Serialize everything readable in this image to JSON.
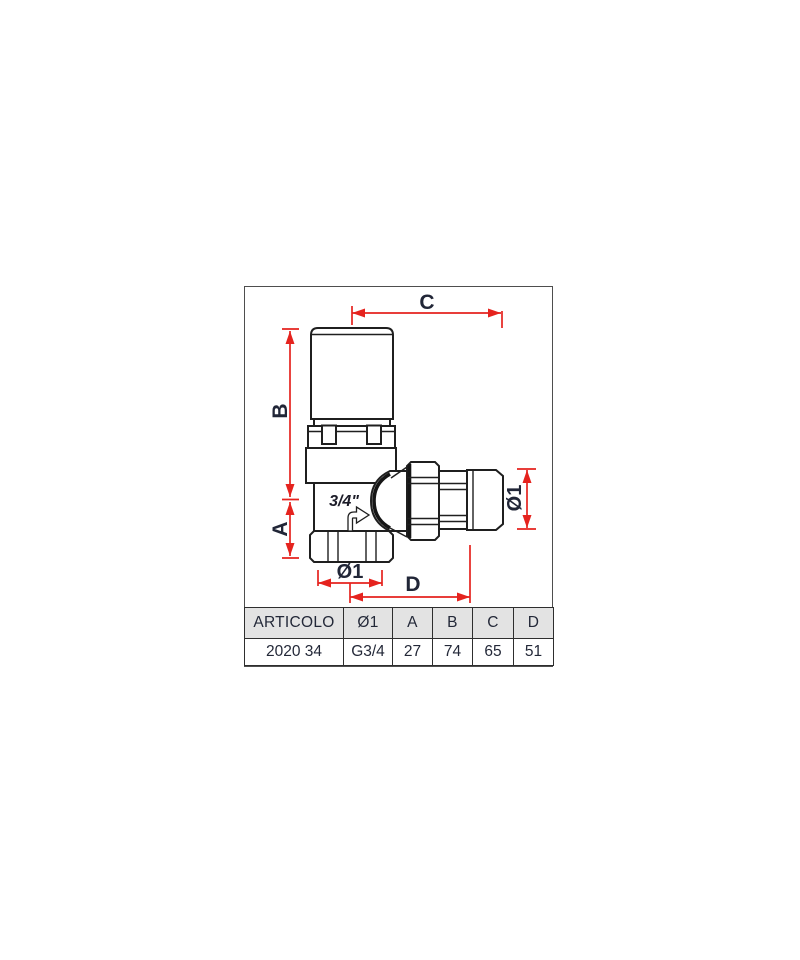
{
  "diagram": {
    "marking": "3/4\"",
    "dims": {
      "c": "C",
      "b": "B",
      "a": "A",
      "d": "D",
      "dia_bottom": "Ø1",
      "dia_right": "Ø1"
    },
    "colors": {
      "dimension_red": "#e5231e",
      "label_navy": "#212637",
      "line_dark": "#1f1f1f",
      "frame_gray": "#4e4e4e",
      "table_header_bg": "#e3e3e3"
    }
  },
  "table": {
    "headers": [
      "ARTICOLO",
      "Ø1",
      "A",
      "B",
      "C",
      "D"
    ],
    "row": [
      "2020 34",
      "G3/4",
      "27",
      "74",
      "65",
      "51"
    ]
  }
}
